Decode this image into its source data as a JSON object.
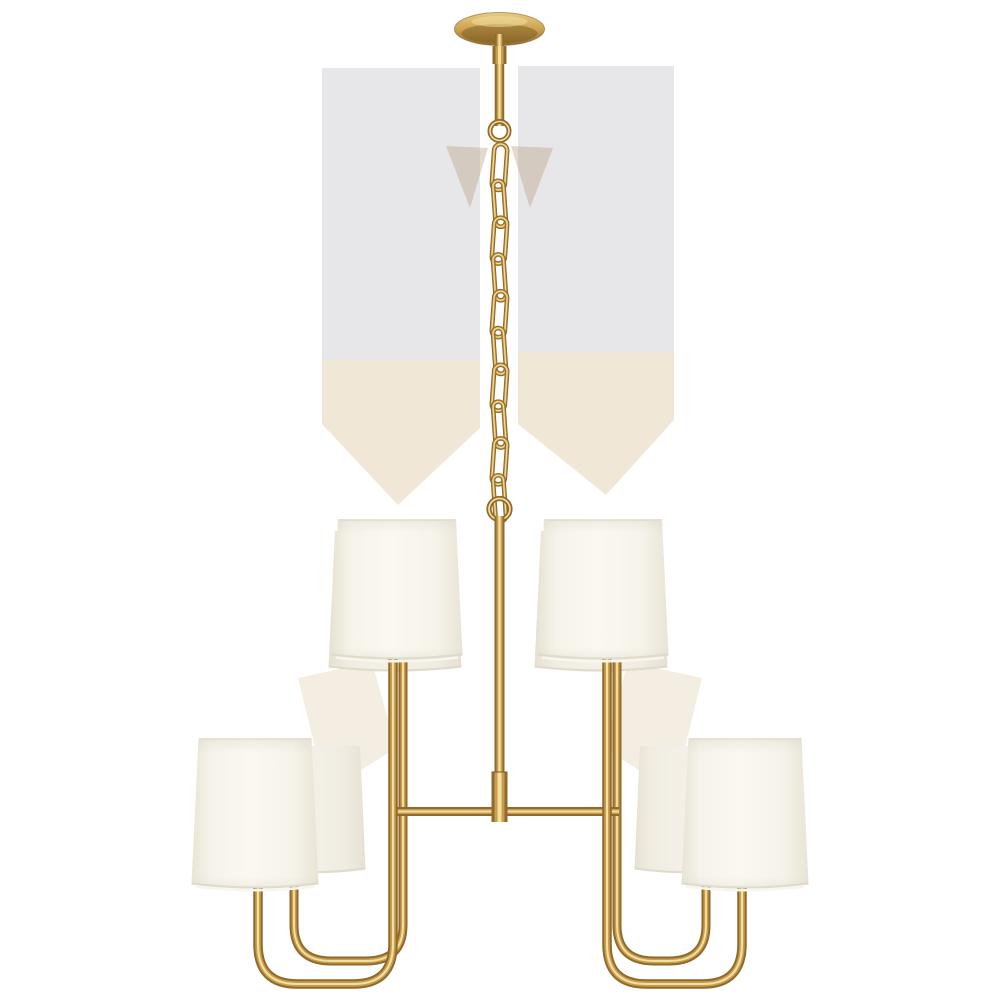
{
  "scene": {
    "title": "Chandelier product photo",
    "description": "Eight-light two-tier chandelier in hand-rubbed antique brass with cream linen drum shades, suspended by a link chain from a round ceiling canopy, on a plain white background",
    "background_color": "#ffffff"
  },
  "colors": {
    "brass_dark": "#8f6a2c",
    "brass_mid": "#c89e4e",
    "brass_highlight": "#f3df9f",
    "brass_deep": "#7a5a22",
    "canopy_top": "#e9cc83",
    "shade_edge": "#e8e4d5",
    "shade_body": "#faf8f1",
    "shade_rim": "#ddd8c8",
    "artifact_gray": "#cfcfd6",
    "artifact_tan": "#dcc49b"
  },
  "chandelier": {
    "tiers": 2,
    "shade_count_visible": 8,
    "chain_links": 10,
    "parts": {
      "canopy": "ceiling canopy",
      "stem": "hanging stem rod",
      "chain": "suspension chain",
      "column": "center column",
      "crossbar": "horizontal crossbar",
      "arms": "U-curved arms",
      "shades": "linen drum shades"
    }
  }
}
